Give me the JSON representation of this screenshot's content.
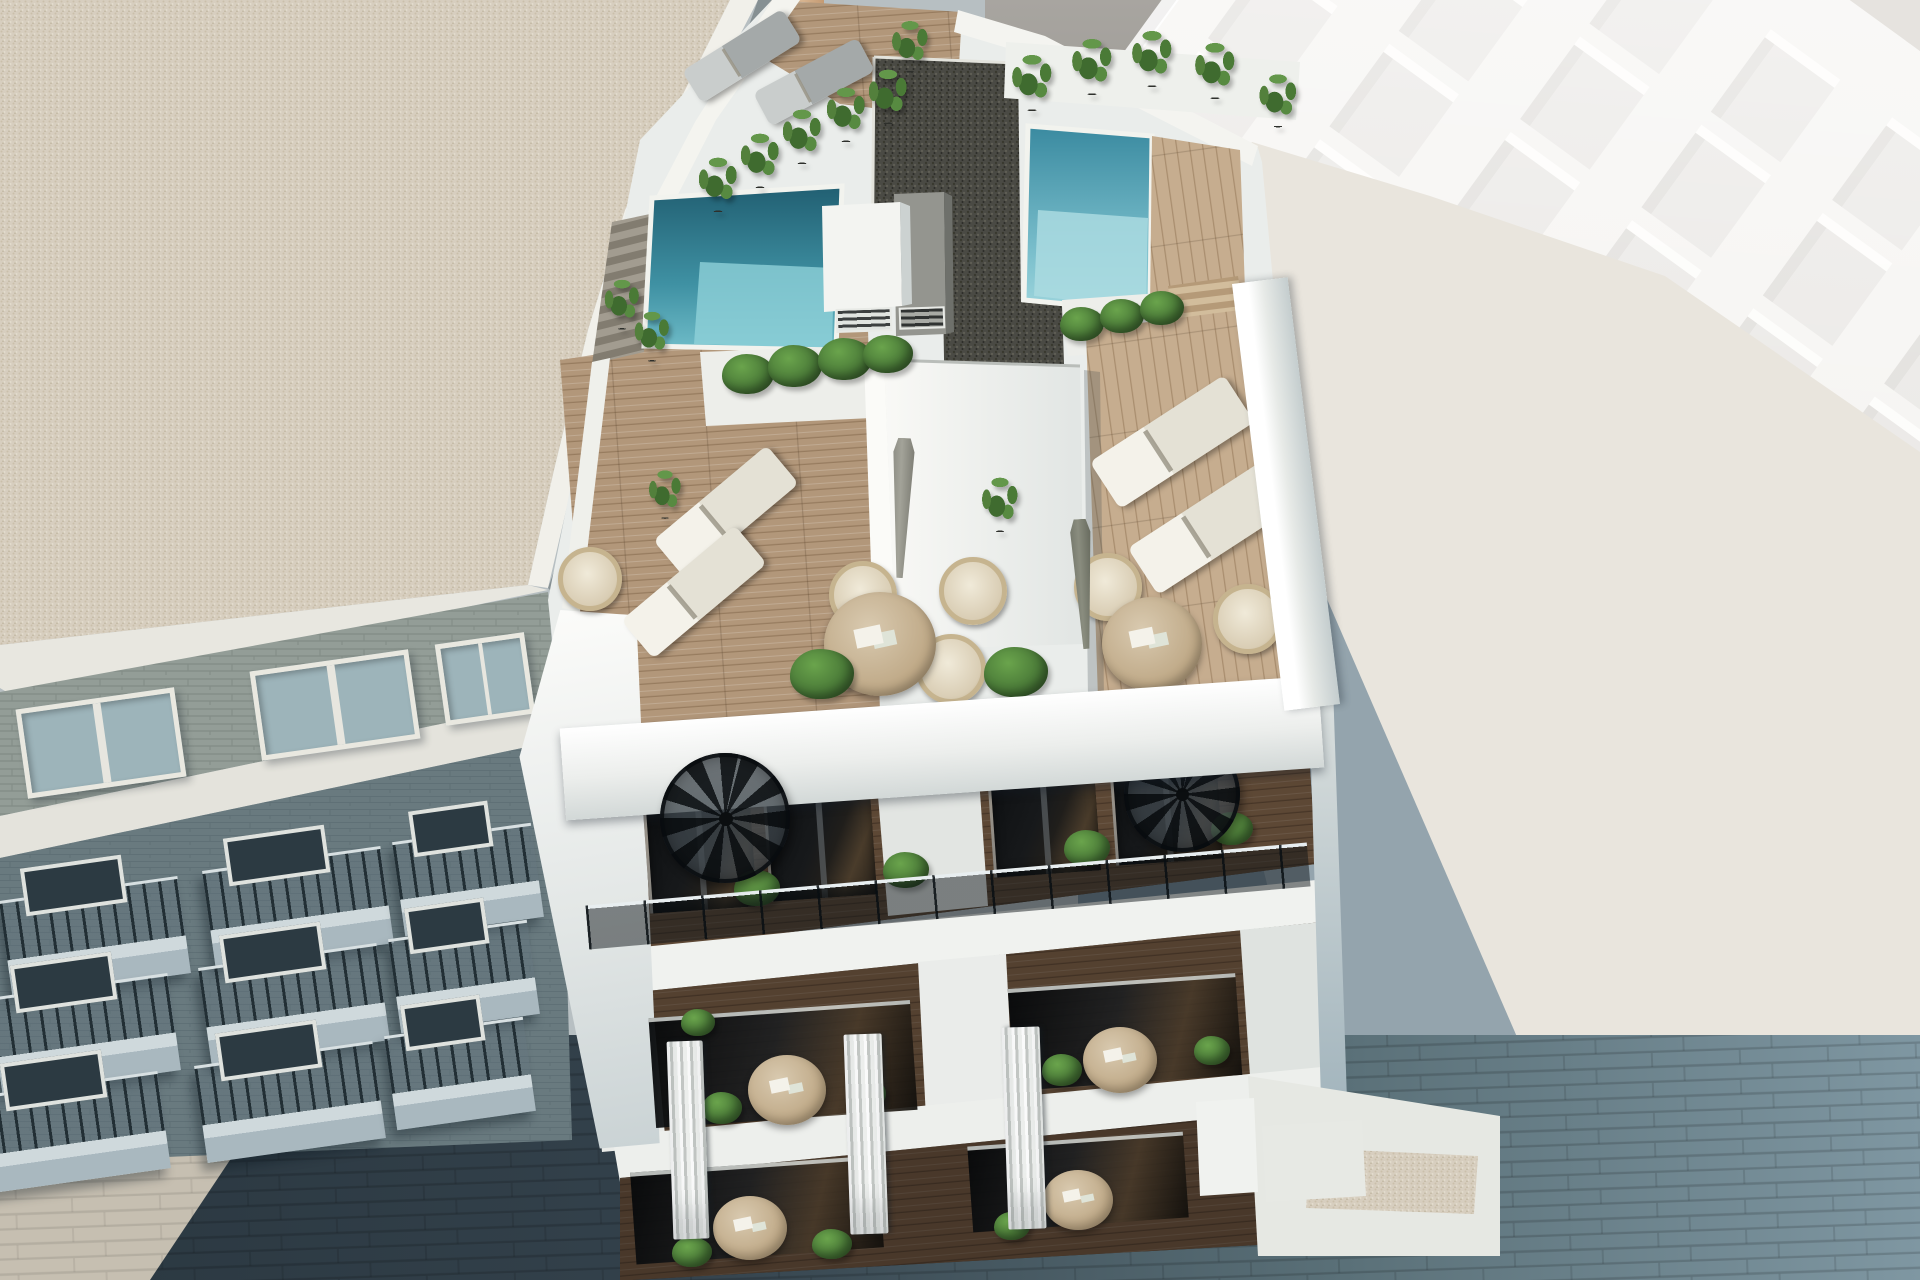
{
  "description": "Aerial 3D architectural rendering of a modern white apartment building rooftop with two swimming pools, wooden sun decks, white loungers, round wicker chairs, plants and spiral staircases, flanked by a brick neighbour building with balconies on the left, a tall white building and a flat roof on the right, and a paved street below.",
  "palette": {
    "pot": "#2e302c",
    "green1": "#6aa44c",
    "green2": "#35592a",
    "pool_deep": "#215f72",
    "pool_light": "#7cc0cd",
    "wood": "#b2977a",
    "gravel_dark": "#4a4a44",
    "gravel_beige": "#d7cebf",
    "white_wall": "#f2f3f0",
    "street": "#33414b"
  },
  "scene": {
    "far_building": {
      "cols": 7,
      "rows": 5,
      "ox": -300,
      "oy": 20,
      "dx": 150,
      "dy": 118,
      "w": 74,
      "h": 92,
      "colors": {
        "face": "#dedbd7",
        "lit": "#fcfbf8",
        "shadow": "#cfccc7"
      }
    },
    "sprites": [
      {
        "t": "balcony",
        "x": 95,
        "y": 935,
        "w": 180,
        "h": 95,
        "r": -8,
        "z": 2
      },
      {
        "t": "balcony",
        "x": 298,
        "y": 905,
        "w": 180,
        "h": 95,
        "r": -8,
        "z": 2
      },
      {
        "t": "balcony",
        "x": 468,
        "y": 878,
        "w": 140,
        "h": 92,
        "r": -8,
        "z": 2
      },
      {
        "t": "balcony",
        "x": 85,
        "y": 1032,
        "w": 180,
        "h": 95,
        "r": -8,
        "z": 2
      },
      {
        "t": "balcony",
        "x": 294,
        "y": 1002,
        "w": 180,
        "h": 95,
        "r": -8,
        "z": 2
      },
      {
        "t": "balcony",
        "x": 464,
        "y": 975,
        "w": 140,
        "h": 92,
        "r": -8,
        "z": 2
      },
      {
        "t": "balcony",
        "x": 75,
        "y": 1130,
        "w": 180,
        "h": 95,
        "r": -8,
        "z": 2
      },
      {
        "t": "balcony",
        "x": 290,
        "y": 1100,
        "w": 180,
        "h": 95,
        "r": -8,
        "z": 2
      },
      {
        "t": "balcony",
        "x": 460,
        "y": 1072,
        "w": 140,
        "h": 92,
        "r": -8,
        "z": 2
      },
      {
        "t": "winL",
        "x": 96,
        "y": 738,
        "w": 150,
        "h": 80,
        "r": -8,
        "z": 2
      },
      {
        "t": "winL",
        "x": 330,
        "y": 700,
        "w": 150,
        "h": 80,
        "r": -8,
        "z": 2
      },
      {
        "t": "winL",
        "x": 480,
        "y": 674,
        "w": 80,
        "h": 72,
        "r": -8,
        "z": 2
      },
      {
        "t": "wedge",
        "x": 591,
        "y": 882,
        "w": 146,
        "h": 544,
        "r": 0,
        "z": 3
      },
      {
        "t": "door",
        "x": 698,
        "y": 848,
        "w": 104,
        "h": 114,
        "r": -4,
        "z": 3
      },
      {
        "t": "door",
        "x": 818,
        "y": 836,
        "w": 104,
        "h": 114,
        "r": -4,
        "z": 3
      },
      {
        "t": "door",
        "x": 1042,
        "y": 812,
        "w": 104,
        "h": 114,
        "r": -4,
        "z": 3
      },
      {
        "t": "door",
        "x": 1164,
        "y": 800,
        "w": 104,
        "h": 114,
        "r": -4,
        "z": 3
      },
      {
        "t": "glassrow",
        "x": 783,
        "y": 1062,
        "w": 262,
        "h": 106,
        "r": -4,
        "z": 3
      },
      {
        "t": "glassrow",
        "x": 1125,
        "y": 1030,
        "w": 228,
        "h": 98,
        "r": -4,
        "z": 3
      },
      {
        "t": "glassrow",
        "x": 757,
        "y": 1208,
        "w": 248,
        "h": 88,
        "r": -4,
        "z": 3
      },
      {
        "t": "glassrow",
        "x": 1078,
        "y": 1180,
        "w": 216,
        "h": 82,
        "r": -4,
        "z": 3
      },
      {
        "t": "lounger",
        "x": 742,
        "y": 56,
        "w": 118,
        "h": 38,
        "r": -32,
        "v": "gray",
        "z": 4
      },
      {
        "t": "lounger",
        "x": 814,
        "y": 82,
        "w": 118,
        "h": 38,
        "r": -28,
        "v": "gray",
        "z": 4
      },
      {
        "t": "lounger",
        "x": 726,
        "y": 512,
        "w": 148,
        "h": 50,
        "r": -40,
        "z": 4
      },
      {
        "t": "lounger",
        "x": 694,
        "y": 592,
        "w": 148,
        "h": 50,
        "r": -40,
        "z": 4
      },
      {
        "t": "lounger",
        "x": 1172,
        "y": 442,
        "w": 160,
        "h": 56,
        "r": -33,
        "z": 4
      },
      {
        "t": "lounger",
        "x": 1210,
        "y": 528,
        "w": 160,
        "h": 56,
        "r": -33,
        "z": 4
      },
      {
        "t": "chair",
        "x": 585,
        "y": 574,
        "w": 54,
        "h": 54,
        "r": 0,
        "z": 4
      },
      {
        "t": "chair",
        "x": 858,
        "y": 590,
        "w": 58,
        "h": 58,
        "r": 0,
        "z": 4
      },
      {
        "t": "chair",
        "x": 968,
        "y": 586,
        "w": 58,
        "h": 58,
        "r": 0,
        "z": 4
      },
      {
        "t": "chair",
        "x": 946,
        "y": 664,
        "w": 60,
        "h": 60,
        "r": 0,
        "z": 4
      },
      {
        "t": "chair",
        "x": 1103,
        "y": 582,
        "w": 58,
        "h": 58,
        "r": 0,
        "z": 4
      },
      {
        "t": "chair",
        "x": 1243,
        "y": 614,
        "w": 60,
        "h": 60,
        "r": 0,
        "z": 4
      },
      {
        "t": "table",
        "x": 880,
        "y": 644,
        "w": 112,
        "h": 104,
        "r": 0,
        "z": 4
      },
      {
        "t": "table",
        "x": 1152,
        "y": 644,
        "w": 100,
        "h": 94,
        "r": 0,
        "z": 4
      },
      {
        "t": "table",
        "x": 787,
        "y": 1090,
        "w": 78,
        "h": 70,
        "r": 0,
        "z": 4
      },
      {
        "t": "table",
        "x": 1120,
        "y": 1060,
        "w": 74,
        "h": 66,
        "r": 0,
        "z": 4
      },
      {
        "t": "table",
        "x": 750,
        "y": 1228,
        "w": 74,
        "h": 64,
        "r": 0,
        "z": 4
      },
      {
        "t": "table",
        "x": 1078,
        "y": 1200,
        "w": 70,
        "h": 60,
        "r": 0,
        "z": 4
      },
      {
        "t": "parasol",
        "x": 902,
        "y": 508,
        "w": 44,
        "h": 140,
        "r": 2,
        "z": 4
      },
      {
        "t": "parasol",
        "x": 1083,
        "y": 584,
        "w": 42,
        "h": 130,
        "r": -3,
        "v": "dark",
        "z": 4
      },
      {
        "t": "vent",
        "x": 862,
        "y": 318,
        "w": 52,
        "h": 20,
        "r": -2,
        "z": 4
      },
      {
        "t": "vent",
        "x": 920,
        "y": 316,
        "w": 42,
        "h": 18,
        "r": -2,
        "z": 4
      },
      {
        "t": "plant",
        "x": 718,
        "y": 182,
        "w": 60,
        "h": 70,
        "r": 0,
        "z": 4
      },
      {
        "t": "plant",
        "x": 760,
        "y": 158,
        "w": 60,
        "h": 70,
        "r": 0,
        "z": 4
      },
      {
        "t": "plant",
        "x": 802,
        "y": 134,
        "w": 60,
        "h": 70,
        "r": 0,
        "z": 4
      },
      {
        "t": "plant",
        "x": 846,
        "y": 112,
        "w": 60,
        "h": 70,
        "r": 0,
        "z": 4
      },
      {
        "t": "plant",
        "x": 888,
        "y": 94,
        "w": 60,
        "h": 70,
        "r": 0,
        "z": 4
      },
      {
        "t": "plant",
        "x": 910,
        "y": 44,
        "w": 56,
        "h": 66,
        "r": 0,
        "z": 4
      },
      {
        "t": "plant",
        "x": 1032,
        "y": 80,
        "w": 62,
        "h": 72,
        "r": 0,
        "z": 4
      },
      {
        "t": "plant",
        "x": 1092,
        "y": 64,
        "w": 62,
        "h": 72,
        "r": 0,
        "z": 4
      },
      {
        "t": "plant",
        "x": 1152,
        "y": 56,
        "w": 62,
        "h": 72,
        "r": 0,
        "z": 4
      },
      {
        "t": "plant",
        "x": 1215,
        "y": 68,
        "w": 62,
        "h": 72,
        "r": 0,
        "z": 4
      },
      {
        "t": "plant",
        "x": 1278,
        "y": 98,
        "w": 58,
        "h": 68,
        "r": 0,
        "z": 4
      },
      {
        "t": "plant",
        "x": 622,
        "y": 302,
        "w": 54,
        "h": 64,
        "r": 0,
        "z": 4
      },
      {
        "t": "plant",
        "x": 652,
        "y": 334,
        "w": 54,
        "h": 64,
        "r": 0,
        "z": 4
      },
      {
        "t": "plant",
        "x": 1000,
        "y": 502,
        "w": 56,
        "h": 70,
        "r": 0,
        "z": 4
      },
      {
        "t": "plant",
        "x": 665,
        "y": 492,
        "w": 50,
        "h": 62,
        "r": 0,
        "z": 4
      },
      {
        "t": "bush",
        "x": 748,
        "y": 374,
        "w": 52,
        "h": 40,
        "r": 0,
        "z": 4
      },
      {
        "t": "bush",
        "x": 795,
        "y": 366,
        "w": 54,
        "h": 42,
        "r": 0,
        "z": 4
      },
      {
        "t": "bush",
        "x": 845,
        "y": 359,
        "w": 54,
        "h": 42,
        "r": 0,
        "z": 4
      },
      {
        "t": "bush",
        "x": 888,
        "y": 354,
        "w": 50,
        "h": 38,
        "r": 0,
        "z": 4
      },
      {
        "t": "bush",
        "x": 1082,
        "y": 324,
        "w": 44,
        "h": 34,
        "r": 0,
        "z": 4
      },
      {
        "t": "bush",
        "x": 1122,
        "y": 316,
        "w": 44,
        "h": 34,
        "r": 0,
        "z": 4
      },
      {
        "t": "bush",
        "x": 1162,
        "y": 308,
        "w": 44,
        "h": 34,
        "r": 0,
        "z": 4
      },
      {
        "t": "bush",
        "x": 822,
        "y": 674,
        "w": 64,
        "h": 50,
        "r": 0,
        "z": 4
      },
      {
        "t": "bush",
        "x": 1016,
        "y": 672,
        "w": 64,
        "h": 50,
        "r": 0,
        "z": 4
      },
      {
        "t": "bush",
        "x": 757,
        "y": 888,
        "w": 46,
        "h": 36,
        "r": 0,
        "z": 4
      },
      {
        "t": "bush",
        "x": 906,
        "y": 870,
        "w": 46,
        "h": 36,
        "r": 0,
        "z": 4
      },
      {
        "t": "bush",
        "x": 1087,
        "y": 848,
        "w": 46,
        "h": 36,
        "r": 0,
        "z": 4
      },
      {
        "t": "bush",
        "x": 1232,
        "y": 828,
        "w": 42,
        "h": 33,
        "r": 0,
        "z": 4
      },
      {
        "t": "bush",
        "x": 722,
        "y": 1108,
        "w": 40,
        "h": 32,
        "r": 0,
        "z": 4
      },
      {
        "t": "bush",
        "x": 866,
        "y": 1094,
        "w": 40,
        "h": 32,
        "r": 0,
        "z": 4
      },
      {
        "t": "bush",
        "x": 1062,
        "y": 1070,
        "w": 40,
        "h": 32,
        "r": 0,
        "z": 4
      },
      {
        "t": "bush",
        "x": 1212,
        "y": 1050,
        "w": 36,
        "h": 29,
        "r": 0,
        "z": 4
      },
      {
        "t": "bush",
        "x": 692,
        "y": 1252,
        "w": 40,
        "h": 30,
        "r": 0,
        "z": 4
      },
      {
        "t": "bush",
        "x": 832,
        "y": 1244,
        "w": 40,
        "h": 30,
        "r": 0,
        "z": 4
      },
      {
        "t": "bush",
        "x": 1012,
        "y": 1226,
        "w": 36,
        "h": 28,
        "r": 0,
        "z": 4
      },
      {
        "t": "bush",
        "x": 698,
        "y": 1022,
        "w": 34,
        "h": 27,
        "r": 0,
        "z": 4
      },
      {
        "t": "spiral",
        "x": 1182,
        "y": 794,
        "w": 116,
        "h": 116,
        "r": 0,
        "z": 4
      },
      {
        "t": "parapet",
        "x": 942,
        "y": 748,
        "w": 760,
        "h": 92,
        "r": -4,
        "z": 5
      },
      {
        "t": "parapetE",
        "x": 1286,
        "y": 494,
        "w": 56,
        "h": 430,
        "r": -7,
        "z": 5
      },
      {
        "t": "rail",
        "x": 948,
        "y": 896,
        "w": 724,
        "h": 44,
        "r": -5,
        "z": 6
      },
      {
        "t": "spiral",
        "x": 725,
        "y": 818,
        "w": 130,
        "h": 130,
        "r": 0,
        "z": 7
      },
      {
        "t": "pillar",
        "x": 688,
        "y": 1140,
        "w": 36,
        "h": 198,
        "r": -2,
        "z": 8
      },
      {
        "t": "pillar",
        "x": 866,
        "y": 1134,
        "w": 38,
        "h": 200,
        "r": -2,
        "z": 8
      },
      {
        "t": "pillar",
        "x": 1024,
        "y": 1128,
        "w": 38,
        "h": 202,
        "r": -2,
        "z": 8
      }
    ]
  }
}
